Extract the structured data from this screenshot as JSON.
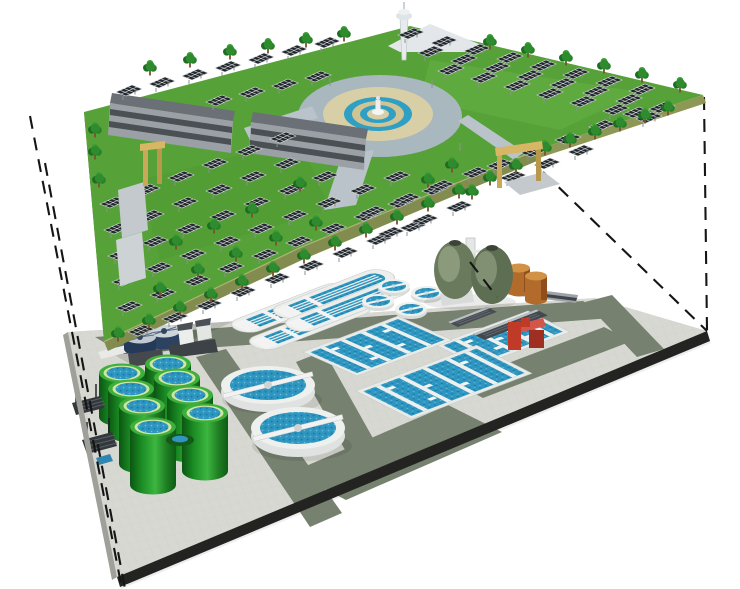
{
  "scene": {
    "kind": "cutaway-axonometric-illustration",
    "upper_level": {
      "label": "surface solar park deck",
      "features": {
        "solar_panel_rows": 15,
        "solar_panels": 96,
        "trees": 48,
        "office_buildings": 2,
        "gate_arches": 2,
        "observation_towers": 1,
        "fountain_plazas": 1
      }
    },
    "lower_level": {
      "label": "underground wastewater treatment plant",
      "equipment": {
        "green_digester_tanks": 8,
        "egg_shaped_digesters": 2,
        "large_clarifiers": 2,
        "small_clarifiers": 4,
        "oxidation_ditches": 4,
        "aeration_basin_blocks": 3,
        "orange_storage_tanks": 2,
        "red_equipment_units": 1,
        "screen_units": 2,
        "thickener_tanks": 2
      }
    },
    "colors": {
      "background": "#ffffff",
      "grass": "#57a238",
      "deck_face": "#818c4e",
      "deck_side": "#6e7a42",
      "platform": "#d7d8d2",
      "road": "#76816f",
      "water": "#2e96c0",
      "tank_green_mid": "#1d8f26",
      "clarifier_white": "#eef0ee",
      "egg_olive": "#6a7a5c",
      "storage_orange": "#b26b2a",
      "equipment_red": "#c03a28",
      "arch_tan": "#d7b765",
      "plaza_tan": "#d8cfa6",
      "plaza_ring": "#a9b7bf",
      "panel_dark": "#23282c",
      "building_gray": "#9aa0a5",
      "projection_line": "#151515",
      "platform_edge_dark": "#232422"
    }
  }
}
